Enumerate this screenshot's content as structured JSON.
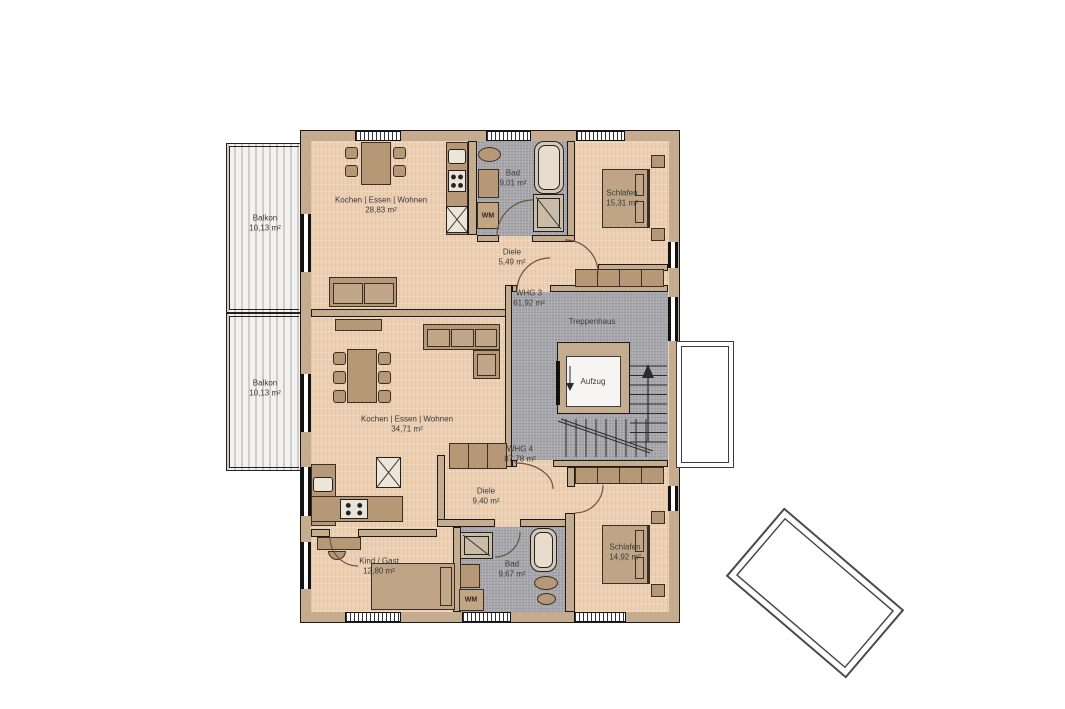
{
  "plan": {
    "balconies": [
      {
        "label": "Balkon",
        "area": "10,13 m²"
      },
      {
        "label": "Balkon",
        "area": "10,13 m²"
      }
    ],
    "whg3": {
      "label": "WHG 3",
      "area": "61,92 m²",
      "rooms": {
        "wohnen": {
          "label": "Kochen | Essen | Wohnen",
          "area": "28,83 m²"
        },
        "bad": {
          "label": "Bad",
          "area": "9,01 m²"
        },
        "wm": {
          "label": "WM"
        },
        "schlafen": {
          "label": "Schlafen",
          "area": "15,31 m²"
        },
        "diele": {
          "label": "Diele",
          "area": "5,49 m²"
        }
      }
    },
    "whg4": {
      "label": "WHG 4",
      "area": "87,78 m²",
      "rooms": {
        "wohnen": {
          "label": "Kochen | Essen | Wohnen",
          "area": "34,71 m²"
        },
        "diele": {
          "label": "Diele",
          "area": "9,40 m²"
        },
        "kind_gast": {
          "label": "Kind / Gast",
          "area": "12,80 m²"
        },
        "bad": {
          "label": "Bad",
          "area": "9,67 m²"
        },
        "wm": {
          "label": "WM"
        },
        "schlafen": {
          "label": "Schlafen",
          "area": "14,92 m²"
        }
      }
    },
    "core": {
      "treppenhaus": {
        "label": "Treppenhaus"
      },
      "aufzug": {
        "label": "Aufzug"
      }
    },
    "colors": {
      "wood_floor": "#ecd0b4",
      "tile_gray": "#a7a7ab",
      "wall_tan": "#c6ac8f",
      "furniture_brown": "#b69877",
      "balcony_gray": "#f3f2f0"
    }
  }
}
